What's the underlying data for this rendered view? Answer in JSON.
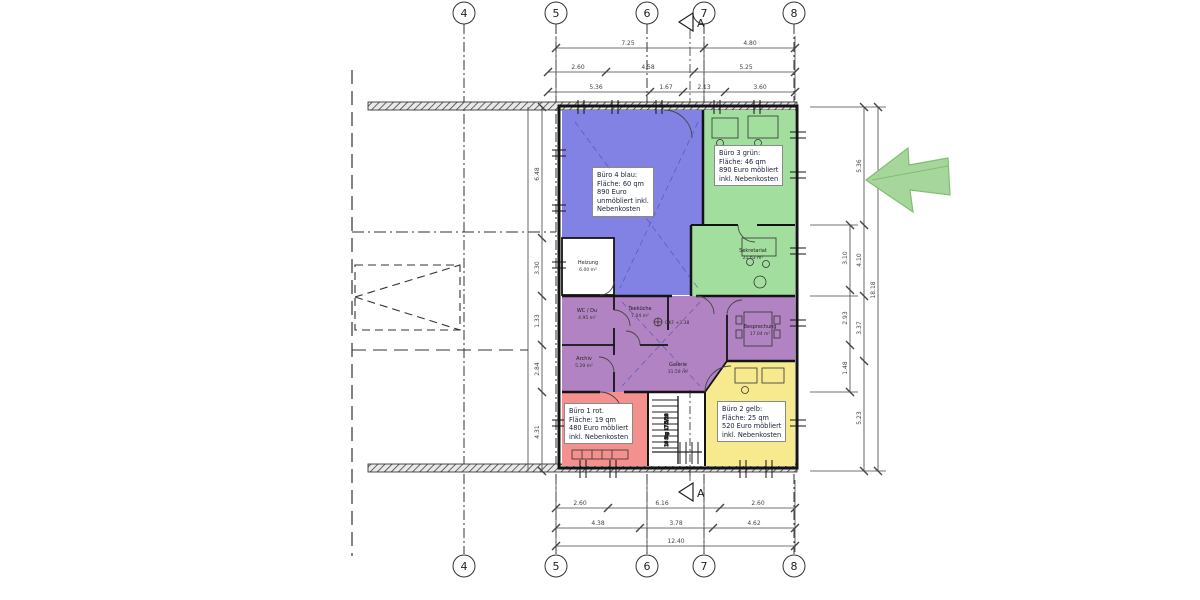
{
  "drawing": {
    "grid_columns": [
      "4",
      "5",
      "6",
      "7",
      "8"
    ],
    "section_label": "A"
  },
  "offices": {
    "blue": {
      "lines": [
        "Büro 4 blau:",
        "Fläche: 60 qm",
        "890 Euro",
        "unmöbliert inkl.",
        "Nebenkosten"
      ]
    },
    "green": {
      "lines": [
        "Büro 3 grün:",
        "Fläche: 46 qm",
        "890 Euro möbliert",
        "inkl. Nebenkosten"
      ]
    },
    "red": {
      "lines": [
        "Büro 1 rot.",
        "Fläche: 19 qm",
        "480 Euro möbliert",
        "inkl. Nebenkosten"
      ]
    },
    "yellow": {
      "lines": [
        "Büro 2 gelb:",
        "Fläche: 25 qm",
        "520 Euro möbliert",
        "inkl. Nebenkosten"
      ]
    }
  },
  "rooms": {
    "heizung": {
      "name": "Heizung",
      "area": "6.00 m²"
    },
    "wc": {
      "name": "WC / Du",
      "area": "4.95 m²"
    },
    "archiv": {
      "name": "Archiv",
      "area": "5.29 m²"
    },
    "teekueche": {
      "name": "Teeküche",
      "area": "7.04 m²"
    },
    "galerie": {
      "name": "Galerie",
      "area": "31.59 m²"
    },
    "besprechung": {
      "name": "Besprechung",
      "area": "17.04 m²"
    },
    "sekretariat": {
      "name": "Sekretariat",
      "area": "21.63 m²"
    }
  },
  "annotations": {
    "level": "OKF +3.38",
    "stairs": "16 Stg 17.5/28"
  },
  "dims": {
    "top_row1": [
      "7.25",
      "4.80"
    ],
    "top_row2": [
      "2.60",
      "4.58",
      "5.25"
    ],
    "top_row3": [
      "5.36",
      "1.67",
      "2.13",
      "3.60"
    ],
    "bottom_row1": [
      "2.60",
      "6.16",
      "2.60"
    ],
    "bottom_row2": [
      "4.38",
      "3.78",
      "4.62"
    ],
    "bottom_total": "12.40",
    "left_col": [
      "6.48",
      "3.30",
      "1.33",
      "2.84",
      "4.31"
    ],
    "right_col1": [
      "3.10",
      "2.93",
      "1.48"
    ],
    "right_col2": [
      "5.36",
      "4.10",
      "3.37",
      "5.23"
    ],
    "right_total": "18.18"
  },
  "colors": {
    "blue": "#8282e4",
    "green": "#a2de9e",
    "purple": "#b183c2",
    "red": "#f4908d",
    "yellow": "#f7e98e",
    "arrow": "#a6d69c"
  }
}
